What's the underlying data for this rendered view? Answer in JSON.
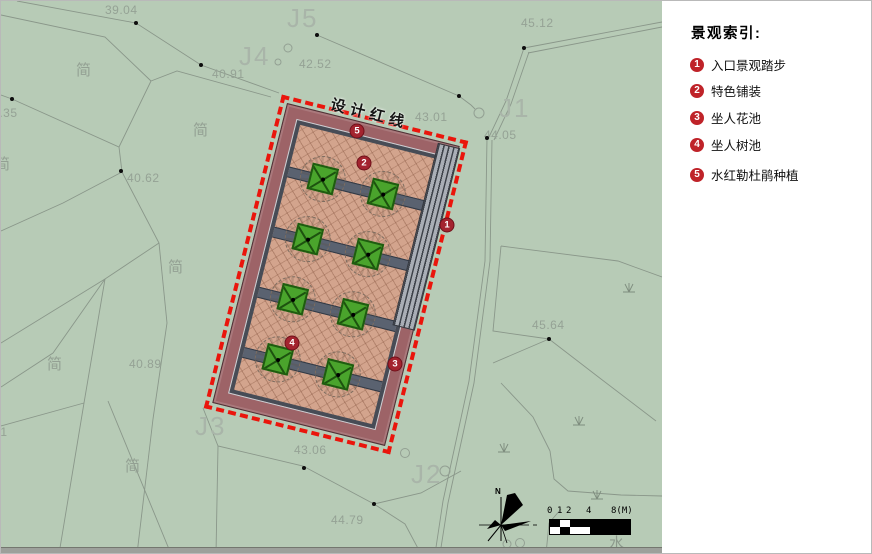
{
  "plan": {
    "red_line_label": "设计红线",
    "north_label": "N",
    "markers": [
      {
        "num": "1",
        "x": 446,
        "y": 224
      },
      {
        "num": "2",
        "x": 363,
        "y": 162
      },
      {
        "num": "3",
        "x": 394,
        "y": 363
      },
      {
        "num": "4",
        "x": 291,
        "y": 342
      },
      {
        "num": "5",
        "x": 356,
        "y": 130
      }
    ],
    "labels": [
      {
        "text": "39.04",
        "x": 104,
        "y": 2,
        "cls": "num-label"
      },
      {
        "text": "40.91",
        "x": 211,
        "y": 66,
        "cls": "num-label"
      },
      {
        "text": "42.52",
        "x": 298,
        "y": 56,
        "cls": "num-label"
      },
      {
        "text": "45.12",
        "x": 520,
        "y": 15,
        "cls": "num-label"
      },
      {
        "text": "43.01",
        "x": 414,
        "y": 109,
        "cls": "num-label"
      },
      {
        "text": "44.05",
        "x": 483,
        "y": 127,
        "cls": "num-label"
      },
      {
        "text": "38.35",
        "x": -16,
        "y": 105,
        "cls": "num-label"
      },
      {
        "text": "40.62",
        "x": 126,
        "y": 170,
        "cls": "num-label"
      },
      {
        "text": "45.64",
        "x": 531,
        "y": 317,
        "cls": "num-label"
      },
      {
        "text": "40.89",
        "x": 128,
        "y": 356,
        "cls": "num-label"
      },
      {
        "text": "43.06",
        "x": 293,
        "y": 442,
        "cls": "num-label"
      },
      {
        "text": "44.79",
        "x": 330,
        "y": 512,
        "cls": "num-label"
      },
      {
        "text": "43.61",
        "x": -26,
        "y": 424,
        "cls": "num-label"
      },
      {
        "text": "J5",
        "x": 286,
        "y": 2,
        "cls": "big-label"
      },
      {
        "text": "J4",
        "x": 238,
        "y": 40,
        "cls": "big-label"
      },
      {
        "text": "J1",
        "x": 498,
        "y": 92,
        "cls": "big-label"
      },
      {
        "text": "J3",
        "x": 194,
        "y": 410,
        "cls": "big-label"
      },
      {
        "text": "J2",
        "x": 410,
        "y": 458,
        "cls": "big-label"
      },
      {
        "text": "简",
        "x": 75,
        "y": 58,
        "cls": "cjk-label"
      },
      {
        "text": "简",
        "x": 192,
        "y": 118,
        "cls": "cjk-label"
      },
      {
        "text": "简",
        "x": 167,
        "y": 255,
        "cls": "cjk-label"
      },
      {
        "text": "简",
        "x": 46,
        "y": 352,
        "cls": "cjk-label"
      },
      {
        "text": "简",
        "x": 124,
        "y": 454,
        "cls": "cjk-label"
      },
      {
        "text": "简",
        "x": -6,
        "y": 152,
        "cls": "cjk-label"
      },
      {
        "text": "水",
        "x": 608,
        "y": 531,
        "cls": "shui-label"
      }
    ],
    "scale_bar": {
      "ticks": [
        {
          "text": "0",
          "dx": 0
        },
        {
          "text": "1",
          "dx": 10
        },
        {
          "text": "2",
          "dx": 19
        },
        {
          "text": "4",
          "dx": 39
        },
        {
          "text": "8(M)",
          "dx": 64
        }
      ]
    }
  },
  "legend": {
    "title": "景观索引:",
    "items": [
      {
        "num": "1",
        "label": "入口景观踏步"
      },
      {
        "num": "2",
        "label": "特色铺装"
      },
      {
        "num": "3",
        "label": "坐人花池"
      },
      {
        "num": "4",
        "label": "坐人树池"
      },
      {
        "num": "5",
        "label": "水红勒杜鹃种植"
      }
    ]
  },
  "colors": {
    "plan_background": "#b7cbb6",
    "red_line": "#ea150c",
    "plaza_band": "#9d6367",
    "paving": "#d3a48d",
    "path_band": "#5a6270",
    "steps": "#a9aeb6",
    "tree_green": "#4aa42c",
    "plan_badge": "#a3242f",
    "legend_badge": "#bf2329",
    "parcel_line": "#8a978a"
  }
}
